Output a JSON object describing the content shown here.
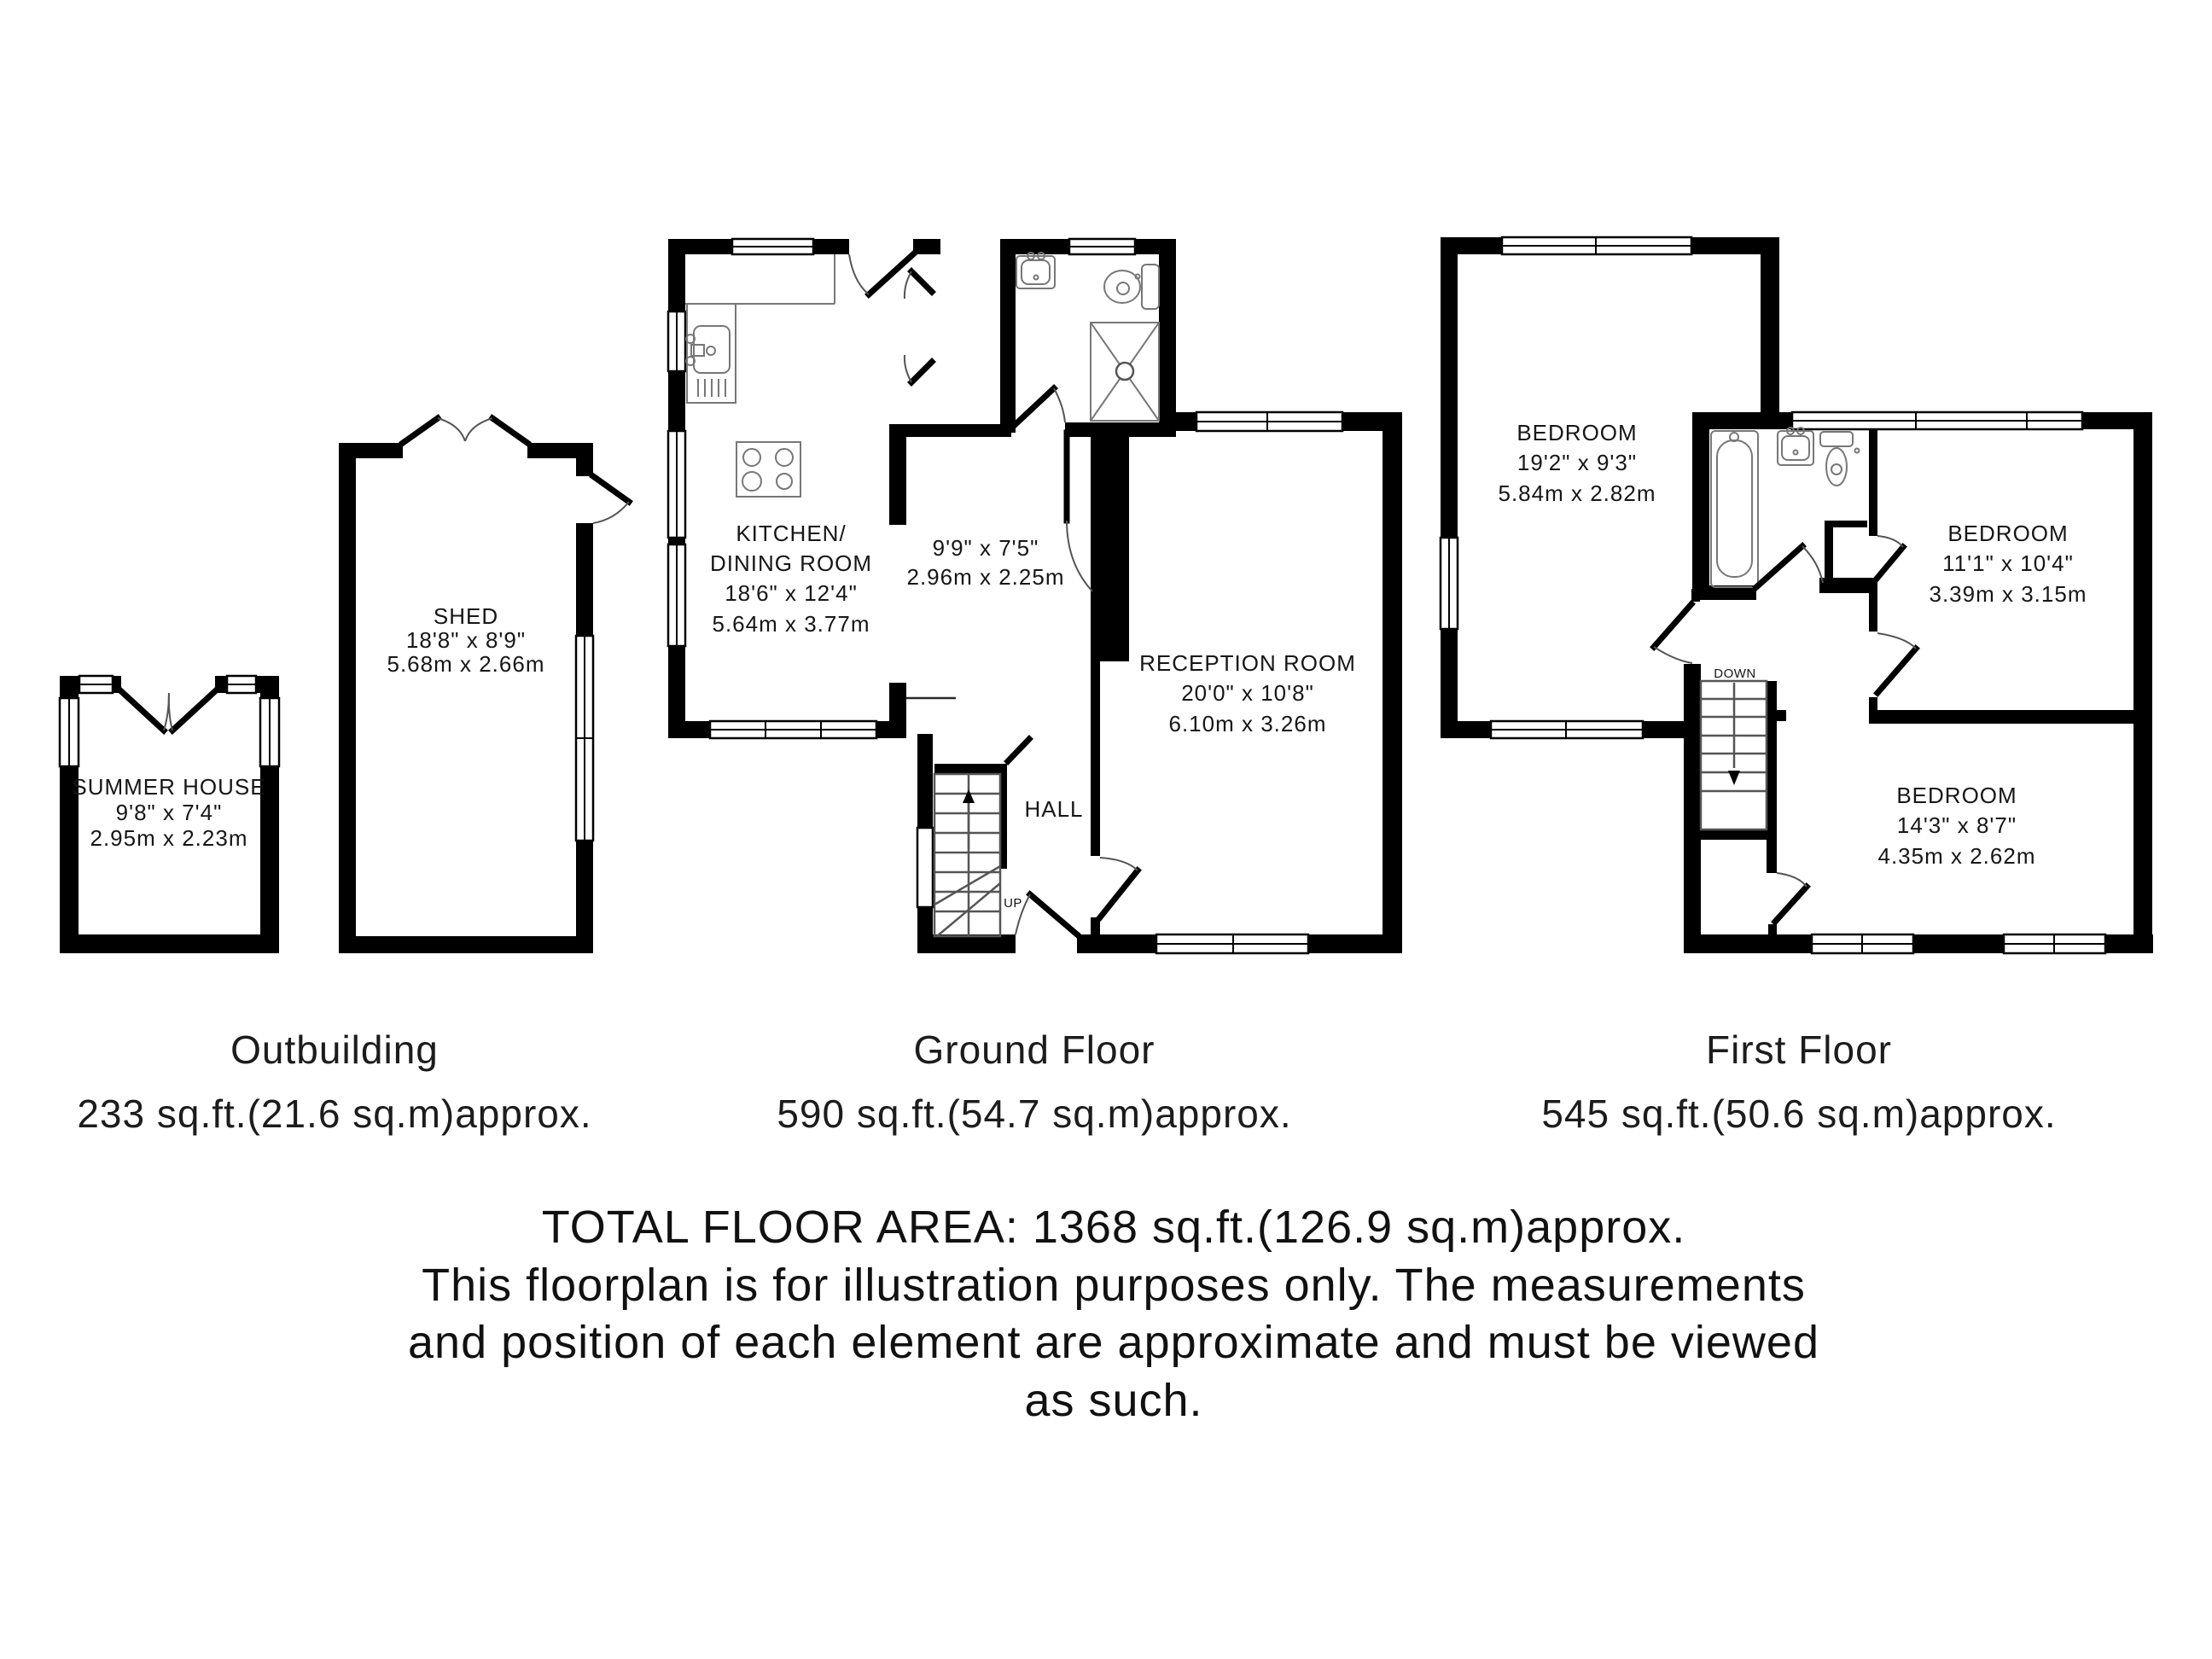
{
  "colors": {
    "wall": "#000000",
    "text": "#161616",
    "background": "#ffffff"
  },
  "outbuilding": {
    "summer_house": {
      "name": "SUMMER HOUSE",
      "imperial": "9'8\" x 7'4\"",
      "metric": "2.95m x 2.23m"
    },
    "shed": {
      "name": "SHED",
      "imperial": "18'8\" x 8'9\"",
      "metric": "5.68m x 2.66m"
    },
    "caption": "Outbuilding",
    "area": "233 sq.ft.(21.6 sq.m)approx."
  },
  "ground_floor": {
    "kitchen": {
      "name_line1": "KITCHEN/",
      "name_line2": "DINING ROOM",
      "imperial": "18'6\" x 12'4\"",
      "metric": "5.64m x 3.77m"
    },
    "store_room": {
      "imperial": "9'9\" x 7'5\"",
      "metric": "2.96m x 2.25m"
    },
    "reception": {
      "name": "RECEPTION ROOM",
      "imperial": "20'0\" x 10'8\"",
      "metric": "6.10m x 3.26m"
    },
    "hall": {
      "name": "HALL"
    },
    "stairs_label": "UP",
    "caption": "Ground Floor",
    "area": "590 sq.ft.(54.7 sq.m)approx."
  },
  "first_floor": {
    "bedroom_1": {
      "name": "BEDROOM",
      "imperial": "19'2\" x 9'3\"",
      "metric": "5.84m x 2.82m"
    },
    "bedroom_2": {
      "name": "BEDROOM",
      "imperial": "11'1\" x 10'4\"",
      "metric": "3.39m x 3.15m"
    },
    "bedroom_3": {
      "name": "BEDROOM",
      "imperial": "14'3\" x 8'7\"",
      "metric": "4.35m x 2.62m"
    },
    "stairs_label": "DOWN",
    "caption": "First Floor",
    "area": "545 sq.ft.(50.6 sq.m)approx."
  },
  "footer": {
    "total": "TOTAL FLOOR AREA: 1368 sq.ft.(126.9 sq.m)approx.",
    "disclaimer_line1": "This floorplan is for illustration purposes only. The measurements",
    "disclaimer_line2": "and position of each element are approximate and must be viewed",
    "disclaimer_line3": "as such."
  }
}
